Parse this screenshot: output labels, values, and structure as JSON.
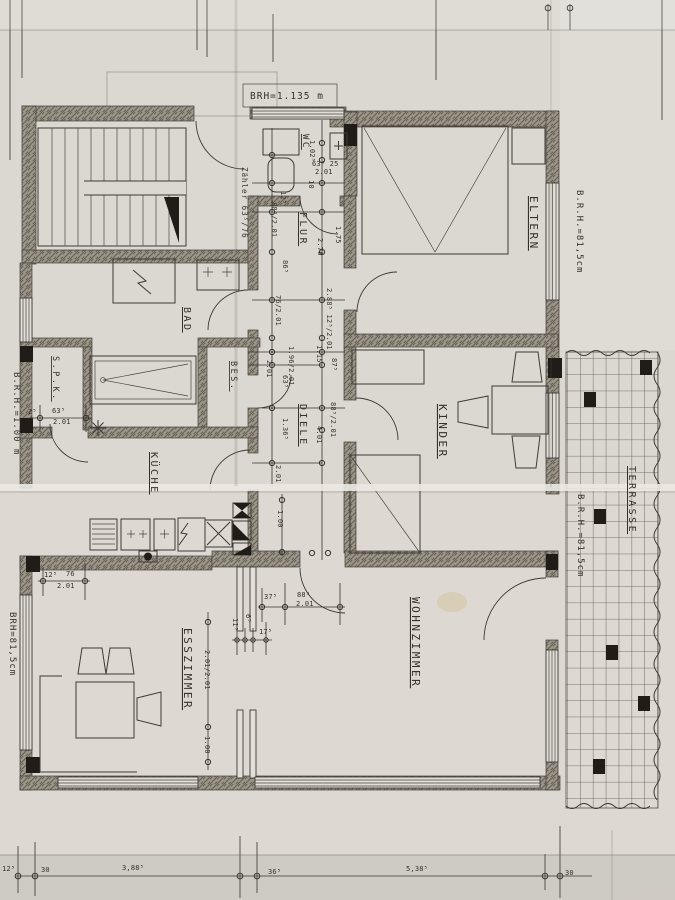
{
  "document_type": "scanned architectural floor plan",
  "colors": {
    "paper": "#dbd8d1",
    "paper_bright_fold": "#ebe8e2",
    "ink": "#3d3a35",
    "wall_fill": "#9b958a",
    "black_elements": "#201d19"
  },
  "room_labels": [
    {
      "n": "room-label-wc",
      "t": "WC",
      "x": 303,
      "y": 134,
      "r": 90,
      "s": 9
    },
    {
      "n": "room-label-eltern",
      "t": "ELTERN",
      "x": 530,
      "y": 196,
      "r": 90,
      "s": 11
    },
    {
      "n": "room-label-flur",
      "t": "FLUR",
      "x": 300,
      "y": 212,
      "r": 90,
      "s": 10
    },
    {
      "n": "room-label-bad",
      "t": "BAD",
      "x": 184,
      "y": 307,
      "r": 90,
      "s": 10
    },
    {
      "n": "room-label-spk",
      "t": "S.P.K.",
      "x": 53,
      "y": 356,
      "r": 90,
      "s": 8.5
    },
    {
      "n": "room-label-bes",
      "t": "BES.",
      "x": 231,
      "y": 361,
      "r": 90,
      "s": 8.5
    },
    {
      "n": "room-label-diele",
      "t": "DIELE",
      "x": 300,
      "y": 404,
      "r": 90,
      "s": 10
    },
    {
      "n": "room-label-kinder",
      "t": "KINDER",
      "x": 439,
      "y": 404,
      "r": 90,
      "s": 11
    },
    {
      "n": "room-label-kueche",
      "t": "KÜCHE",
      "x": 151,
      "y": 452,
      "r": 90,
      "s": 10
    },
    {
      "n": "room-label-esszimmer",
      "t": "ESSZIMMER",
      "x": 184,
      "y": 628,
      "r": 90,
      "s": 11
    },
    {
      "n": "room-label-wohnzimmer",
      "t": "WOHNZIMMER",
      "x": 412,
      "y": 597,
      "r": 90,
      "s": 11
    },
    {
      "n": "room-label-terrasse",
      "t": "TERRASSE",
      "x": 629,
      "y": 466,
      "r": 90,
      "s": 10
    }
  ],
  "annotations": [
    {
      "n": "annotation-brh-top",
      "t": "BRH=1.135 m",
      "x": 250,
      "y": 99,
      "s": 9.5
    },
    {
      "n": "annotation-brh-right-top",
      "t": "B.R.H.=81,5cm",
      "x": 577,
      "y": 190,
      "r": 90,
      "s": 9
    },
    {
      "n": "annotation-brh-left",
      "t": "B.R.H.=1.00 m",
      "x": 14,
      "y": 372,
      "r": 90,
      "s": 9
    },
    {
      "n": "annotation-brh-left-bottom",
      "t": "BRH=81,5cm",
      "x": 10,
      "y": 612,
      "r": 90,
      "s": 9
    },
    {
      "n": "annotation-brh-right-bottom",
      "t": "B.R.H.=81,5cm",
      "x": 578,
      "y": 494,
      "r": 90,
      "s": 9
    },
    {
      "n": "annotation-zaehler",
      "t": "Zähler 63⁵/76",
      "x": 242,
      "y": 167,
      "r": 90,
      "s": 7.5
    }
  ],
  "dimensions": [
    {
      "t": "1.02⁵",
      "x": 310,
      "y": 140,
      "r": 90
    },
    {
      "t": "63⁵ 25",
      "x": 312,
      "y": 166,
      "s": 6.5
    },
    {
      "t": "2.01",
      "x": 315,
      "y": 174,
      "s": 6.5
    },
    {
      "t": "10",
      "x": 309,
      "y": 180,
      "r": 90
    },
    {
      "t": "12⁵",
      "x": 281,
      "y": 191,
      "r": 90
    },
    {
      "t": "88⁵/2.01",
      "x": 272,
      "y": 202,
      "r": 90
    },
    {
      "t": "86⁵",
      "x": 283,
      "y": 260,
      "r": 90
    },
    {
      "t": "2.76",
      "x": 318,
      "y": 238,
      "r": 90
    },
    {
      "t": "1.75",
      "x": 336,
      "y": 226,
      "r": 90
    },
    {
      "t": "76/2.01",
      "x": 276,
      "y": 295,
      "r": 90
    },
    {
      "t": "2.88⁵ 12⁵/2.01",
      "x": 327,
      "y": 288,
      "r": 90,
      "s": 6.5
    },
    {
      "t": "1.96/2.01",
      "x": 289,
      "y": 346,
      "r": 90,
      "s": 6.5
    },
    {
      "t": "1.15",
      "x": 317,
      "y": 345,
      "r": 90
    },
    {
      "t": "2.01",
      "x": 267,
      "y": 360,
      "r": 90
    },
    {
      "t": "63⁵",
      "x": 283,
      "y": 375,
      "r": 90
    },
    {
      "t": "87⁵",
      "x": 332,
      "y": 358,
      "r": 90
    },
    {
      "t": "88⁵/2.01",
      "x": 331,
      "y": 402,
      "r": 90
    },
    {
      "t": "1.36⁵",
      "x": 283,
      "y": 418,
      "r": 90
    },
    {
      "t": "4.01",
      "x": 317,
      "y": 426,
      "r": 90
    },
    {
      "t": "2.01",
      "x": 276,
      "y": 465,
      "r": 90
    },
    {
      "t": "2⁵",
      "x": 28,
      "y": 414,
      "s": 6.5
    },
    {
      "t": "63⁵",
      "x": 52,
      "y": 413
    },
    {
      "t": "2.01",
      "x": 53,
      "y": 424
    },
    {
      "t": "12⁵",
      "x": 44,
      "y": 577
    },
    {
      "t": "76",
      "x": 66,
      "y": 576
    },
    {
      "t": "2.01",
      "x": 57,
      "y": 588
    },
    {
      "t": "2.01/2.01",
      "x": 205,
      "y": 650,
      "r": 90,
      "s": 6.5
    },
    {
      "t": "1.00",
      "x": 205,
      "y": 736,
      "r": 90
    },
    {
      "t": "1.00",
      "x": 278,
      "y": 510,
      "r": 90
    },
    {
      "t": "37⁵",
      "x": 264,
      "y": 599
    },
    {
      "t": "88⁵",
      "x": 297,
      "y": 597
    },
    {
      "t": "2.01",
      "x": 296,
      "y": 606
    },
    {
      "t": "11⁵",
      "x": 233,
      "y": 618,
      "r": 90,
      "s": 6.5
    },
    {
      "t": "6⁵",
      "x": 246,
      "y": 614,
      "r": 90,
      "s": 6.5
    },
    {
      "t": "17⁵",
      "x": 259,
      "y": 634,
      "s": 6.5
    },
    {
      "t": "12⁵",
      "x": 2,
      "y": 871,
      "s": 8
    },
    {
      "t": "30",
      "x": 41,
      "y": 872,
      "s": 8
    },
    {
      "t": "3,88⁵",
      "x": 122,
      "y": 870,
      "s": 9
    },
    {
      "t": "36⁵",
      "x": 268,
      "y": 874,
      "s": 9
    },
    {
      "t": "5,38⁵",
      "x": 406,
      "y": 871,
      "s": 9
    },
    {
      "t": "30",
      "x": 565,
      "y": 875,
      "s": 8
    }
  ],
  "terrace_tiles": [
    {
      "x": 640,
      "y": 360
    },
    {
      "x": 584,
      "y": 392
    },
    {
      "x": 594,
      "y": 509
    },
    {
      "x": 606,
      "y": 645
    },
    {
      "x": 638,
      "y": 696
    },
    {
      "x": 593,
      "y": 759
    }
  ]
}
